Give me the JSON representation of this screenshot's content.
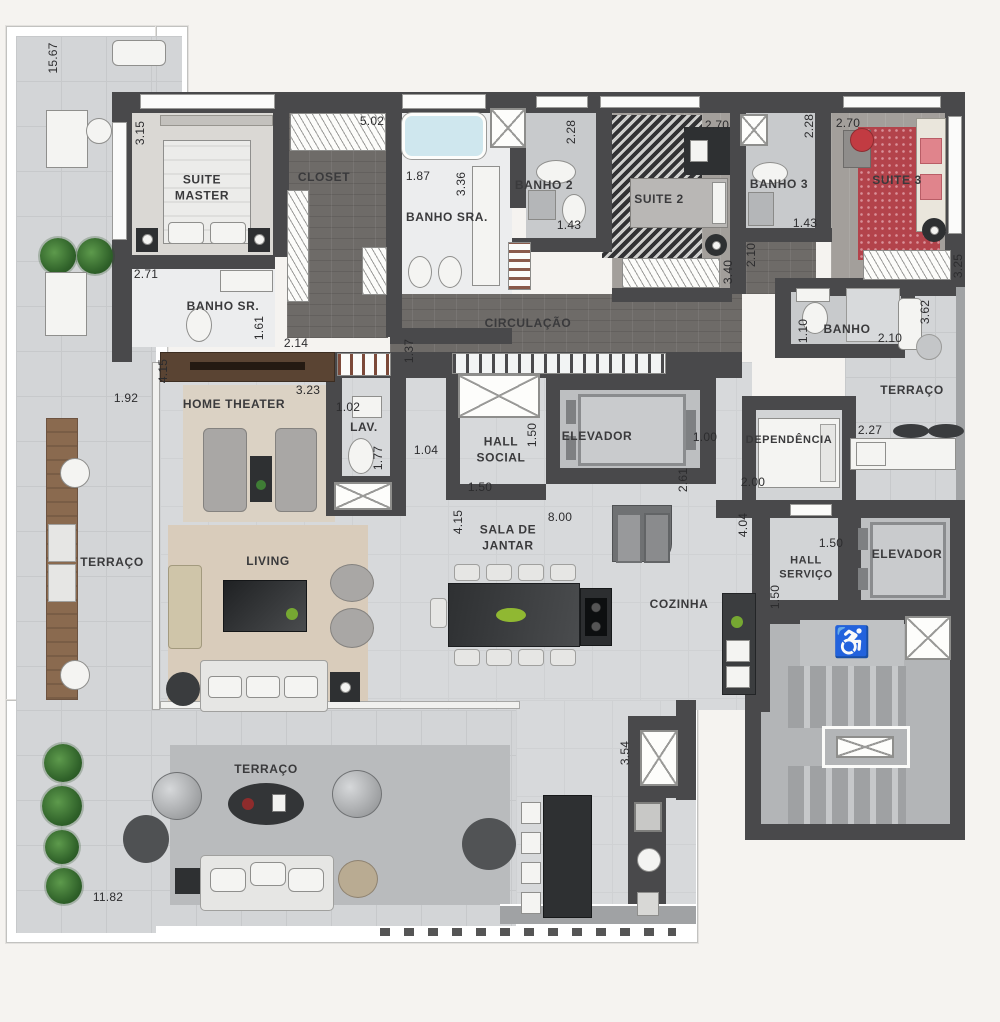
{
  "labels": {
    "suite_master": "SUITE\nMASTER",
    "closet": "CLOSET",
    "banho_sra": "BANHO SRA.",
    "banho_2": "BANHO 2",
    "suite_2": "SUITE 2",
    "banho_3": "BANHO 3",
    "suite_3": "SUITE 3",
    "circulacao": "CIRCULAÇÃO",
    "banho_sr": "BANHO SR.",
    "home_theater": "HOME THEATER",
    "lav": "LAV.",
    "hall_social": "HALL\nSOCIAL",
    "elevador_social": "ELEVADOR",
    "banho_dependencia": "BANHO",
    "terraco_servico": "TERRAÇO",
    "dependencia": "DEPENDÊNCIA",
    "terraco_lateral": "TERRAÇO",
    "living": "LIVING",
    "sala_de_jantar": "SALA DE\nJANTAR",
    "cozinha": "COZINHA",
    "hall_servico": "HALL\nSERVIÇO",
    "elevador_servico": "ELEVADOR",
    "terraco_inferior": "TERRAÇO"
  },
  "dims": {
    "terraco_15_67": "15.67",
    "suite_master_3_15": "3.15",
    "suite_master_2_71": "2.71",
    "closet_5_02": "5.02",
    "banho_sra_1_87": "1.87",
    "banho_sra_3_36": "3.36",
    "banho2_2_28": "2.28",
    "banho2_1_43": "1.43",
    "suite2_2_70": "2.70",
    "suite2_3_40": "3.40",
    "banho3_2_28": "2.28",
    "banho3_1_43": "1.43",
    "suite3_2_70": "2.70",
    "suite3_3_25": "3.25",
    "hall_suites_2_10": "2.10",
    "banho_sr_1_61": "1.61",
    "banho_sr_2_14": "2.14",
    "circulacao_1_37": "1.37",
    "home_theater_4_15": "4.15",
    "home_theater_3_23": "3.23",
    "terraco_1_92": "1.92",
    "lav_1_02": "1.02",
    "lav_1_77": "1.77",
    "hall_1_04": "1.04",
    "hall_social_1_50_v": "1.50",
    "hall_social_1_50_h": "1.50",
    "dependencia_1_00": "1.00",
    "dependencia_2_61": "2.61",
    "dependencia_2_00": "2.00",
    "banho_dep_1_10": "1.10",
    "banho_dep_2_10": "2.10",
    "terraco_serv_3_62": "3.62",
    "terraco_serv_2_27": "2.27",
    "sala_8_00": "8.00",
    "sala_4_15": "4.15",
    "cozinha_4_04": "4.04",
    "hall_serv_1_50_h": "1.50",
    "hall_serv_1_50_v": "1.50",
    "cozinha_3_54": "3.54",
    "terraco_11_82": "11.82"
  },
  "icons": {
    "accessibility": "♿"
  },
  "colors": {
    "wall": "#49494b",
    "social_floor": "#d7d9db",
    "terrace_floor": "#d3d5d7",
    "wood_floor": "#6e6b68",
    "suite3_rug": "#b3434b",
    "living_rug": "#d9ccbb",
    "background": "#f5f3f0"
  }
}
